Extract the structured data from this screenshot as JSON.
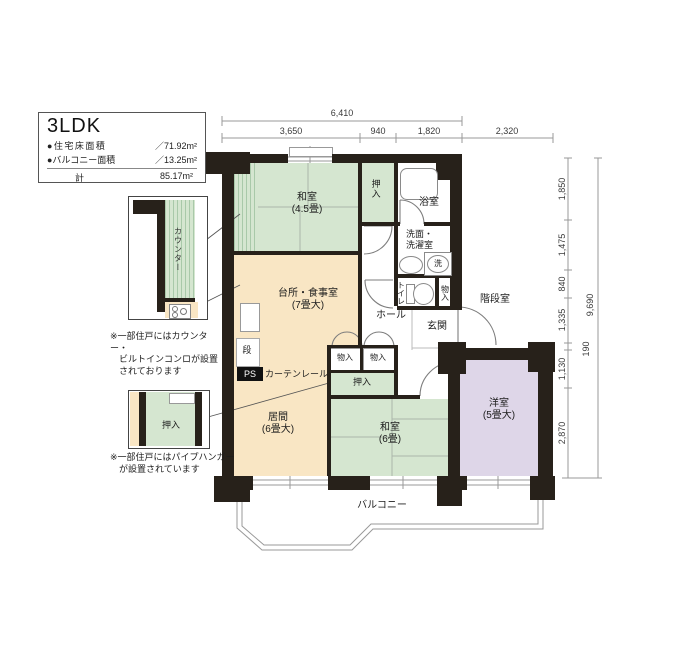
{
  "info": {
    "title": "3LDK",
    "rows": [
      {
        "label": "●住宅床面積",
        "value": "／71.92m²"
      },
      {
        "label": "●バルコニー面積",
        "value": "／13.25m²"
      }
    ],
    "total_label": "計",
    "total_value": "85.17m²"
  },
  "dims": {
    "top_total": "6,410",
    "top": [
      "3,650",
      "940",
      "1,820",
      "2,320"
    ],
    "right": [
      "1,850",
      "1,475",
      "840",
      "1,335",
      "1,130",
      "2,870"
    ],
    "right_total": "9,690",
    "right_step": "190"
  },
  "rooms": {
    "washitsu45_name": "和室",
    "washitsu45_size": "(4.5畳)",
    "oshiire_top": "押入",
    "bath": "浴室",
    "senmen_l1": "洗面・",
    "senmen_l2": "洗濯室",
    "laundry": "洗",
    "toilet": "トイレ",
    "storage_wc": "物入",
    "hall": "ホール",
    "genkan": "玄関",
    "stairwell": "階段室",
    "kitchen_name": "台所・食事室",
    "kitchen_size": "(7畳大)",
    "step": "段",
    "ps": "PS",
    "curtain_rail": "カーテンレール",
    "storage_a": "物入",
    "storage_b": "物入",
    "oshiire_mid": "押入",
    "living_name": "居間",
    "living_size": "(6畳大)",
    "washitsu6_name": "和室",
    "washitsu6_size": "(6畳)",
    "yoshitsu_name": "洋室",
    "yoshitsu_size": "(5畳大)",
    "balcony": "バルコニー"
  },
  "callouts": {
    "counter_label": "カウンター",
    "counter_note": [
      "※一部住戸にはカウンター・",
      "ビルトインコンロが設置",
      "されております"
    ],
    "oshiire_label": "押入",
    "oshiire_note": [
      "※一部住戸にはパイプハンガー",
      "が設置されています"
    ]
  },
  "colors": {
    "wall": "#27211a",
    "tatami": "#d5e6d0",
    "wood": "#f9e6c4",
    "western": "#ded6e8",
    "stripe": "#a9c9a9"
  }
}
